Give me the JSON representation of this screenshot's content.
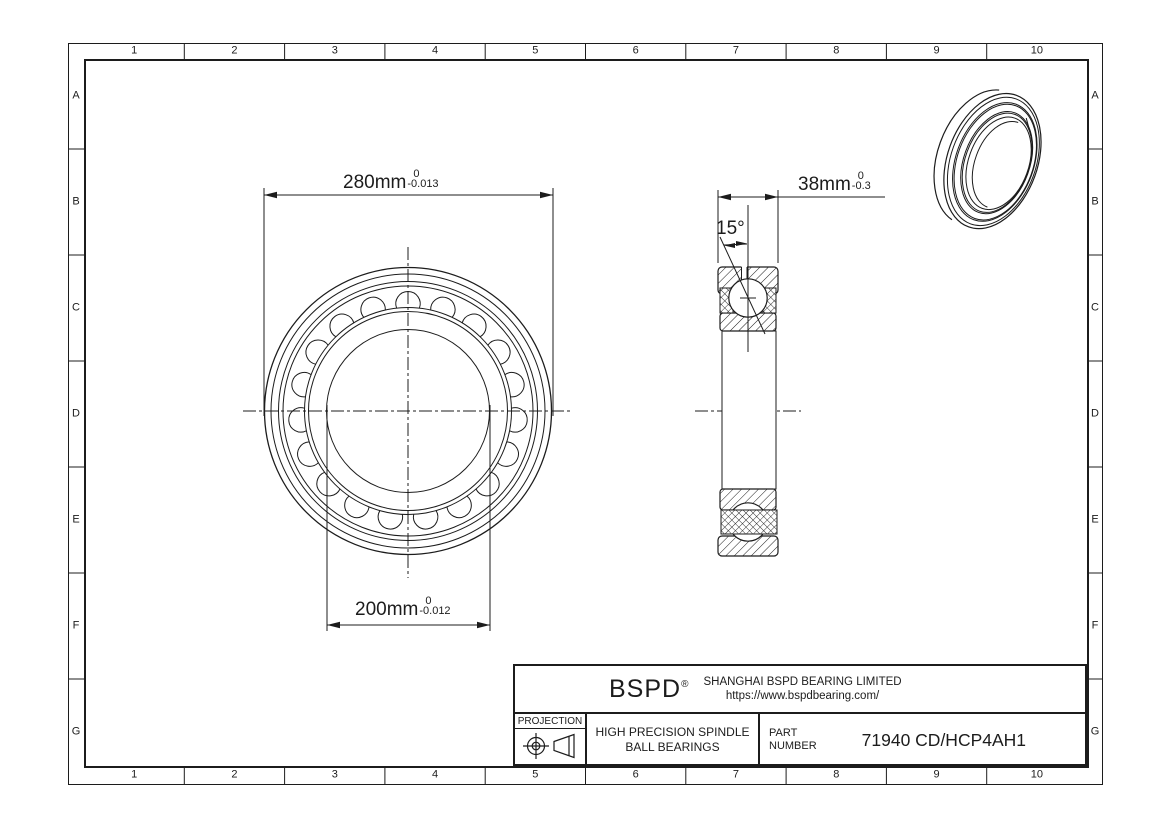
{
  "frame": {
    "columns": [
      "1",
      "2",
      "3",
      "4",
      "5",
      "6",
      "7",
      "8",
      "9",
      "10"
    ],
    "rows": [
      "A",
      "B",
      "C",
      "D",
      "E",
      "F",
      "G"
    ]
  },
  "dimensions": {
    "outer_diameter": {
      "value": "280mm",
      "tolerance_upper": "0",
      "tolerance_lower": "-0.013"
    },
    "bore_diameter": {
      "value": "200mm",
      "tolerance_upper": "0",
      "tolerance_lower": "-0.012"
    },
    "width": {
      "value": "38mm",
      "tolerance_upper": "0",
      "tolerance_lower": "-0.3"
    },
    "contact_angle": {
      "value": "15°"
    }
  },
  "title_block": {
    "brand": "BSPD",
    "registered": "®",
    "company": "SHANGHAI BSPD BEARING LIMITED",
    "website": "https://www.bspdbearing.com/",
    "projection_label": "PROJECTION",
    "product_line1": "HIGH  PRECISION SPINDLE",
    "product_line2": "BALL BEARINGS",
    "part_label_line1": "PART",
    "part_label_line2": "NUMBER",
    "part_number": "71940 CD/HCP4AH1"
  },
  "icons": {
    "projection_symbol": "first-angle-projection-icon"
  },
  "colors": {
    "line": "#1c1c1c",
    "background": "#ffffff"
  }
}
